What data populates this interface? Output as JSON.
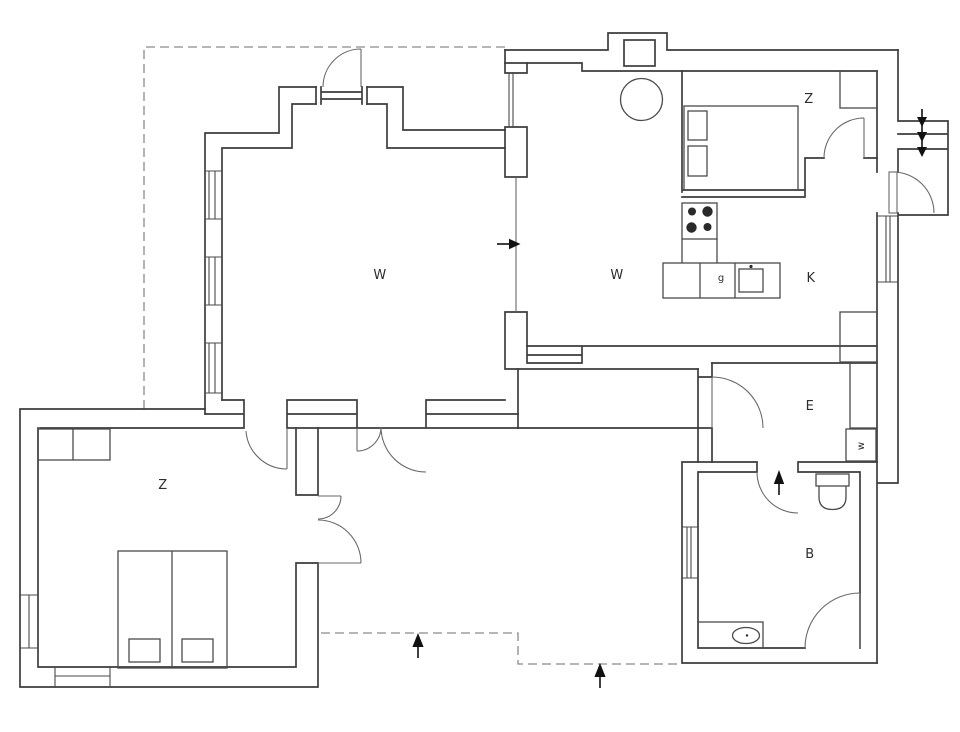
{
  "canvas": {
    "width": 960,
    "height": 732,
    "background": "#ffffff"
  },
  "colors": {
    "wall_line": "#3d3d3d",
    "dashed_boundary": "#8a8a8a",
    "label": "#2d2d2d",
    "arrow": "#111111"
  },
  "rooms": [
    {
      "id": "living-room-west",
      "label": "W"
    },
    {
      "id": "living-dining-east",
      "label": "W"
    },
    {
      "id": "bedroom-northeast",
      "label": "Z"
    },
    {
      "id": "bedroom-southwest",
      "label": "Z"
    },
    {
      "id": "kitchen",
      "label": "K"
    },
    {
      "id": "entrance-hall",
      "label": "E"
    },
    {
      "id": "bathroom",
      "label": "B"
    },
    {
      "id": "kitchen-counter",
      "label": "g"
    },
    {
      "id": "washing-machine",
      "label": "w"
    }
  ],
  "icons": {
    "flow_arrows": [
      "arrow-right-living-passage",
      "arrow-up-terrace-west-entry",
      "arrow-up-terrace-east-entry",
      "arrow-up-hall-to-bathroom",
      "arrow-down-entry-stairs-1",
      "arrow-down-entry-stairs-2",
      "arrow-down-entry-stairs-3"
    ],
    "fixtures": [
      "double-bed-northeast",
      "double-bed-southwest",
      "wardrobe",
      "closet",
      "round-table",
      "chimney",
      "stove-with-burners",
      "kitchen-sink-counter",
      "fridge-box",
      "toilet",
      "washbasin-counter",
      "entry-porch-stairs"
    ]
  }
}
